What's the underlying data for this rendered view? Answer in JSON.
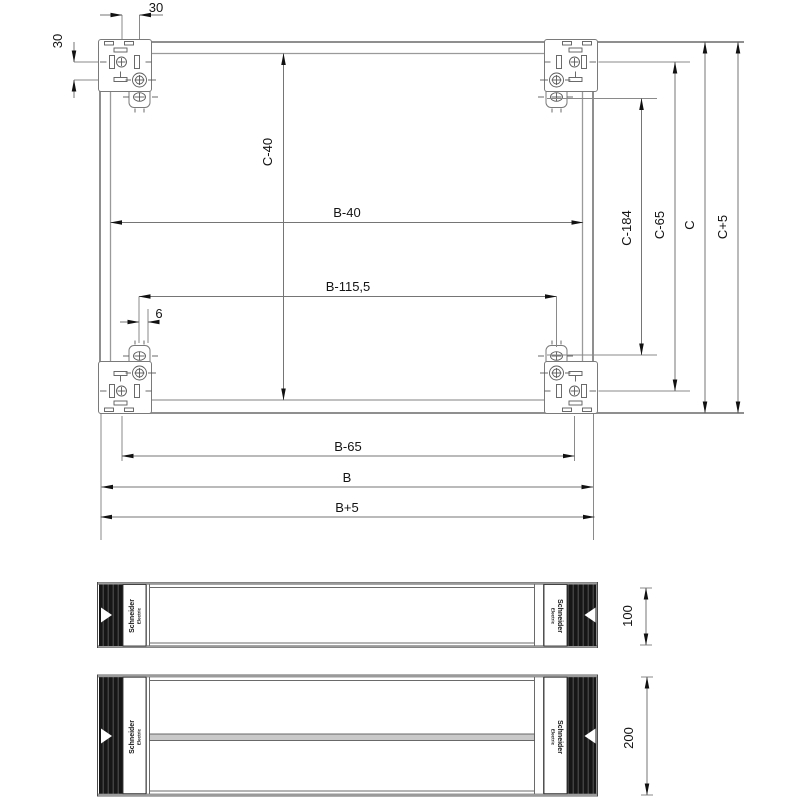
{
  "title": "Plinth technical drawing",
  "colors": {
    "line_gray": "#8a8a8a",
    "dimension_line": "#757575",
    "text": "#141414",
    "dark_block": "#161616",
    "stripe": "#4f4f4f",
    "bar_fill": "#c9c9c9",
    "background": "#ffffff"
  },
  "top_view": {
    "dimensions": {
      "top_spacing": "30",
      "left_spacing": "30",
      "inner_height": "C-40",
      "inner_width": "B-40",
      "bolt_span_width": "B-115,5",
      "slot_offset": "6",
      "c_minus_184": "C-184",
      "c_minus_65": "C-65",
      "c_total": "C",
      "c_plus_5": "C+5",
      "b_minus_65": "B-65",
      "b_total": "B",
      "b_plus_5": "B+5"
    }
  },
  "front_views": {
    "plinth_100": {
      "height_label": "100",
      "brand_line1": "Schneider",
      "brand_line2": "Electric"
    },
    "plinth_200": {
      "height_label": "200",
      "brand_line1": "Schneider",
      "brand_line2": "Electric"
    }
  }
}
